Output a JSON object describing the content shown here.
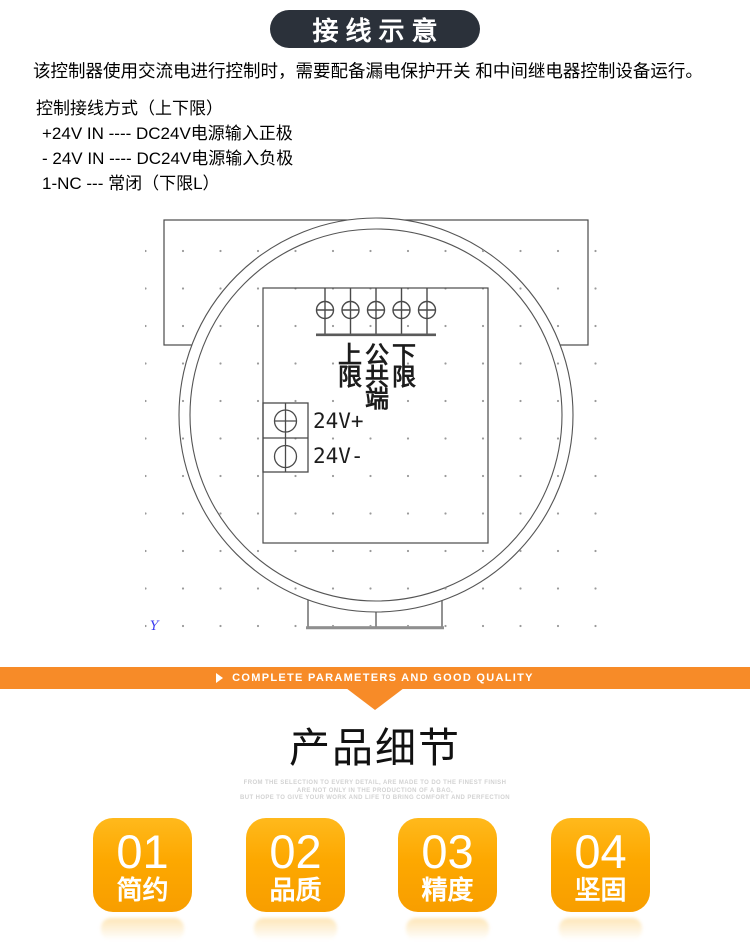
{
  "header": {
    "badge": "接线示意"
  },
  "intro": "该控制器使用交流电进行控制时，需要配备漏电保护开关 和中间继电器控制设备运行。",
  "wiring": {
    "title": "控制接线方式（上下限）",
    "lines": [
      "+24V IN ---- DC24V电源输入正极",
      "- 24V IN ---- DC24V电源输入负极",
      "1-NC --- 常闭（下限L）"
    ]
  },
  "diagram": {
    "columns": [
      {
        "name": "upper-limit",
        "chars": [
          "上",
          "限"
        ]
      },
      {
        "name": "common-terminal",
        "chars": [
          "公",
          "共",
          "端"
        ]
      },
      {
        "name": "lower-limit",
        "chars": [
          "下",
          "限"
        ]
      }
    ],
    "power_terminals": [
      "24V+",
      "24V-"
    ],
    "axis_marker": "Y"
  },
  "banner": {
    "icon": "right-arrow",
    "text": "COMPLETE PARAMETERS AND GOOD QUALITY",
    "color": "#F78B28"
  },
  "details": {
    "title": "产品细节",
    "subtitle_lines": [
      "FROM THE SELECTION TO EVERY DETAIL, ARE MADE TO DO THE FINEST FINISH",
      "ARE NOT ONLY IN THE PRODUCTION OF A BAG,",
      "BUT HOPE TO GIVE YOUR WORK AND LIFE TO BRING COMFORT AND PERFECTION"
    ],
    "badges": [
      {
        "number": "01",
        "label": "简约"
      },
      {
        "number": "02",
        "label": "品质"
      },
      {
        "number": "03",
        "label": "精度"
      },
      {
        "number": "04",
        "label": "坚固"
      }
    ]
  },
  "colors": {
    "header_badge_bg": "#2B313A",
    "accent_orange": "#F78B28",
    "badge_orange": "#FFA800"
  }
}
